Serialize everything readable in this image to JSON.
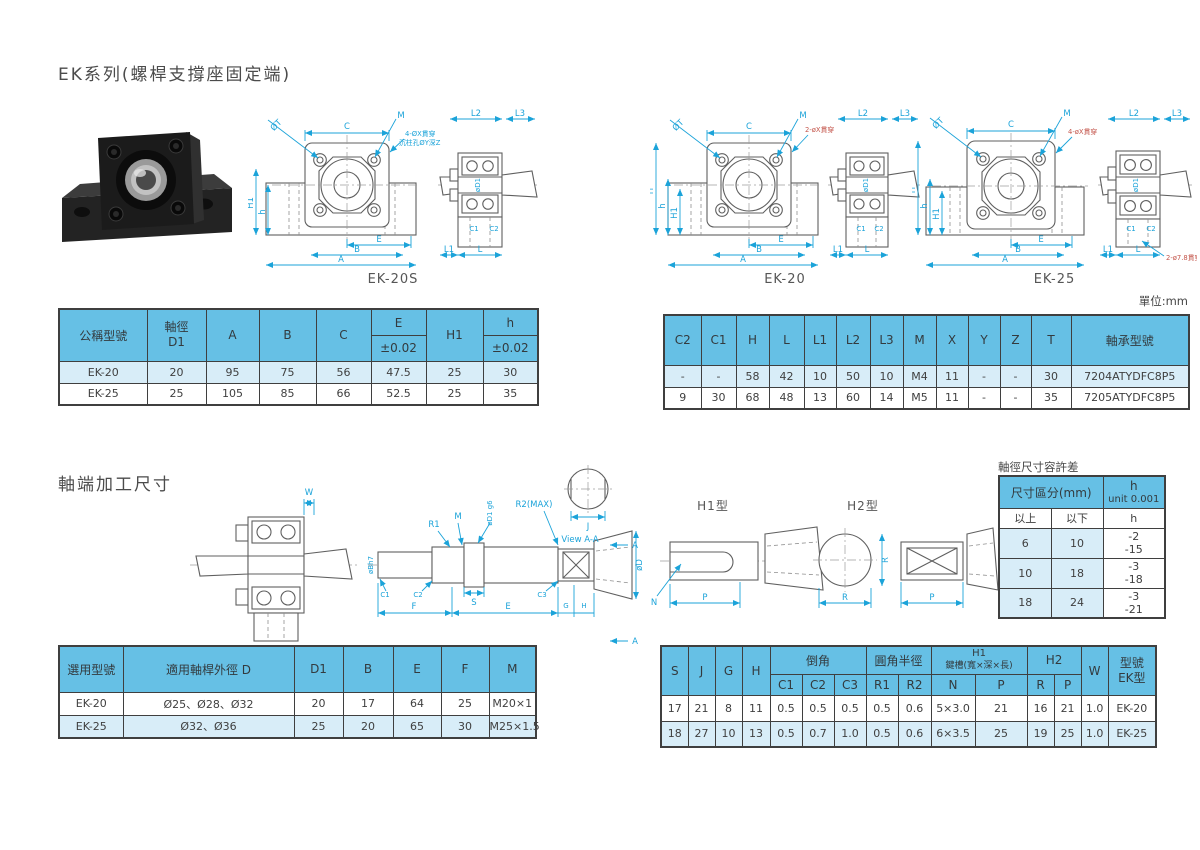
{
  "page": {
    "title": "EK系列(螺桿支撐座固定端)",
    "unit_note": "單位:mm",
    "section2_title": "軸端加工尺寸",
    "tolerance_title": "軸徑尺寸容許差"
  },
  "colors": {
    "table_header_blue": "#66c0e5",
    "table_row_blue": "#d8edf8",
    "dimension_cyan": "#1ba3d9",
    "annotation_red": "#c4564c",
    "line_gray": "#5f5f5f"
  },
  "dwg": {
    "ek20s": {
      "caption": "EK-20S",
      "dt": "ØT",
      "c": "C",
      "m": "M",
      "h1": "H1",
      "h": "h",
      "e": "E",
      "b": "B",
      "a": "A",
      "note1": "4-ØX貫穿",
      "note2": "沉柱孔ØY深Z",
      "l2": "L2",
      "l3": "L3",
      "d1": "øD1",
      "c1": "C1",
      "c2": "C2",
      "l1": "L1",
      "l": "L"
    },
    "ek20": {
      "caption": "EK-20",
      "dt": "ØT",
      "c": "C",
      "m": "M",
      "H": "H",
      "h": "h",
      "h1": "H1",
      "e": "E",
      "b": "B",
      "a": "A",
      "note": "2-øX貫穿",
      "l2": "L2",
      "l3": "L3",
      "d1": "øD1",
      "c1": "C1",
      "c2": "C2",
      "l1": "L1",
      "l": "L"
    },
    "ek25": {
      "caption": "EK-25",
      "dt": "ØT",
      "c": "C",
      "m": "M",
      "H": "H",
      "h": "h",
      "h1": "H1",
      "e": "E",
      "b": "B",
      "a": "A",
      "note1": "4-øX貫穿",
      "note2": "2-ø7.8貫穿",
      "l2": "L2",
      "l3": "L3",
      "d1": "øD1",
      "c1": "C1",
      "c2": "C2",
      "l1": "L1",
      "l": "L"
    },
    "shaft": {
      "w": "W",
      "r1": "R1",
      "m": "M",
      "d1g6": "øD1 g6",
      "r2max": "R2(MAX)",
      "bh7": "øBh7",
      "c1": "C1",
      "c2": "C2",
      "s": "S",
      "c3": "C3",
      "f": "F",
      "e": "E",
      "g": "G",
      "h": "H",
      "j": "J",
      "dd": "øD",
      "view": "View A-A",
      "a": "A"
    },
    "h1type": {
      "caption": "H1型",
      "n": "N",
      "p": "P"
    },
    "h2type": {
      "caption": "H2型",
      "r": "R",
      "r2": "R",
      "p": "P"
    }
  },
  "table1": {
    "headers": {
      "model": "公稱型號",
      "shaft_dia_1": "軸徑",
      "shaft_dia_2": "D1",
      "a": "A",
      "b": "B",
      "c": "C",
      "e": "E",
      "e_tol": "±0.02",
      "h1": "H1",
      "h": "h",
      "h_tol": "±0.02"
    },
    "rows": [
      [
        "EK-20",
        "20",
        "95",
        "75",
        "56",
        "47.5",
        "25",
        "30"
      ],
      [
        "EK-25",
        "25",
        "105",
        "85",
        "66",
        "52.5",
        "25",
        "35"
      ]
    ]
  },
  "table2": {
    "headers": [
      "C2",
      "C1",
      "H",
      "L",
      "L1",
      "L2",
      "L3",
      "M",
      "X",
      "Y",
      "Z",
      "T",
      "軸承型號"
    ],
    "rows": [
      [
        "-",
        "-",
        "58",
        "42",
        "10",
        "50",
        "10",
        "M4",
        "11",
        "-",
        "-",
        "30",
        "7204ATYDFC8P5"
      ],
      [
        "9",
        "30",
        "68",
        "48",
        "13",
        "60",
        "14",
        "M5",
        "11",
        "-",
        "-",
        "35",
        "7205ATYDFC8P5"
      ]
    ]
  },
  "tolerance_table": {
    "header_range": "尺寸區分(mm)",
    "header_h_1": "h",
    "header_h_2": "unit 0.001",
    "sub_headers": [
      "以上",
      "以下",
      "h"
    ],
    "rows": [
      {
        "min": "6",
        "max": "10",
        "tol_upper": "-2",
        "tol_lower": "-15"
      },
      {
        "min": "10",
        "max": "18",
        "tol_upper": "-3",
        "tol_lower": "-18"
      },
      {
        "min": "18",
        "max": "24",
        "tol_upper": "-3",
        "tol_lower": "-21"
      }
    ]
  },
  "table3": {
    "headers": [
      "選用型號",
      "適用軸桿外徑 D",
      "D1",
      "B",
      "E",
      "F",
      "M"
    ],
    "rows": [
      [
        "EK-20",
        "Ø25、Ø28、Ø32",
        "20",
        "17",
        "64",
        "25",
        "M20×1"
      ],
      [
        "EK-25",
        "Ø32、Ø36",
        "25",
        "20",
        "65",
        "30",
        "M25×1.5"
      ]
    ]
  },
  "table4": {
    "top_headers": {
      "s": "S",
      "j": "J",
      "g": "G",
      "h": "H",
      "chamfer": "倒角",
      "radius": "圓角半徑",
      "h1_line1": "H1",
      "h1_line2": "鍵槽(寬×深×長)",
      "h2": "H2",
      "w": "W",
      "model_line1": "型號",
      "model_line2": "EK型"
    },
    "sub_headers": [
      "C1",
      "C2",
      "C3",
      "R1",
      "R2",
      "N",
      "P",
      "R",
      "P"
    ],
    "rows": [
      [
        "17",
        "21",
        "8",
        "11",
        "0.5",
        "0.5",
        "0.5",
        "0.5",
        "0.6",
        "5×3.0",
        "21",
        "16",
        "21",
        "1.0",
        "EK-20"
      ],
      [
        "18",
        "27",
        "10",
        "13",
        "0.5",
        "0.7",
        "1.0",
        "0.5",
        "0.6",
        "6×3.5",
        "25",
        "19",
        "25",
        "1.0",
        "EK-25"
      ]
    ]
  }
}
